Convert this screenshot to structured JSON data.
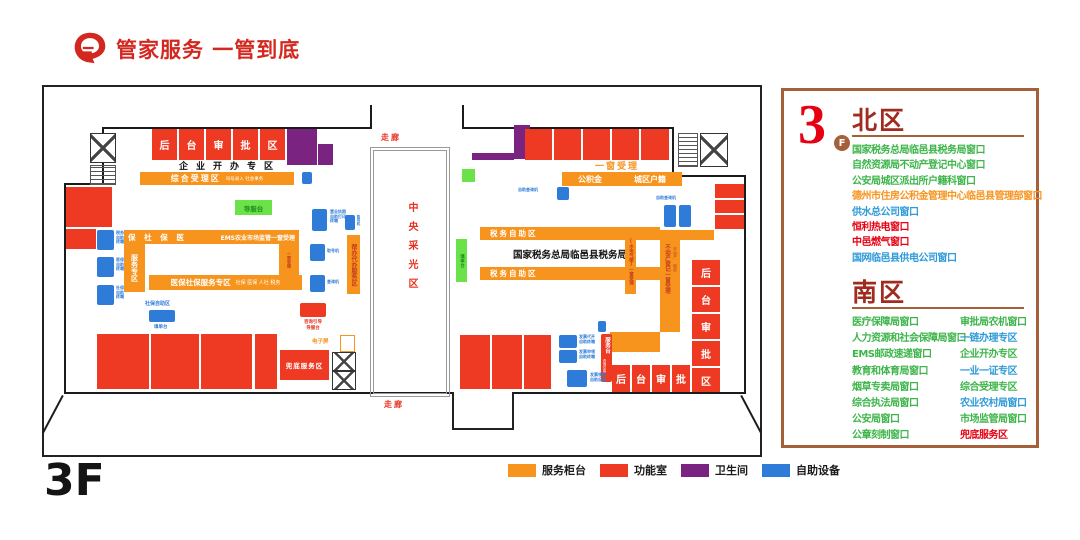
{
  "title": "管家服务 一管到底",
  "floor_big_label": "3F",
  "legend": [
    {
      "label": "服务柜台",
      "color": "#F7941E"
    },
    {
      "label": "功能室",
      "color": "#EE3A22"
    },
    {
      "label": "卫生间",
      "color": "#7B2381"
    },
    {
      "label": "自助设备",
      "color": "#2F7CD8"
    }
  ],
  "panel": {
    "floor_number": "3",
    "floor_badge": "F",
    "north": {
      "heading": "北区",
      "items": [
        {
          "text": "国家税务总局临邑县税务局窗口",
          "color": "#3DB54A"
        },
        {
          "text": "自然资源局不动产登记中心窗口",
          "color": "#3DB54A"
        },
        {
          "text": "公安局城区派出所户籍科窗口",
          "color": "#3DB54A"
        },
        {
          "text": "德州市住房公积金管理中心临邑县管理部窗口",
          "color": "#F7941E"
        },
        {
          "text": "供水总公司窗口",
          "color": "#2E9BD8"
        },
        {
          "text": "恒利热电窗口",
          "color": "#E60012"
        },
        {
          "text": "中邑燃气窗口",
          "color": "#E60012"
        },
        {
          "text": "国网临邑县供电公司窗口",
          "color": "#2E9BD8"
        }
      ]
    },
    "south": {
      "heading": "南区",
      "col1": [
        {
          "text": "医疗保障局窗口",
          "color": "#3DB54A"
        },
        {
          "text": "人力资源和社会保障局窗口",
          "color": "#3DB54A"
        },
        {
          "text": "EMS邮政速递窗口",
          "color": "#3DB54A"
        },
        {
          "text": "教育和体育局窗口",
          "color": "#3DB54A"
        },
        {
          "text": "烟草专卖局窗口",
          "color": "#3DB54A"
        },
        {
          "text": "综合执法局窗口",
          "color": "#3DB54A"
        },
        {
          "text": "公安局窗口",
          "color": "#3DB54A"
        },
        {
          "text": "公章刻制窗口",
          "color": "#3DB54A"
        }
      ],
      "col2": [
        {
          "text": "审批局农机窗口",
          "color": "#3DB54A"
        },
        {
          "text": "一链办理专区",
          "color": "#2E9BD8"
        },
        {
          "text": "企业开办专区",
          "color": "#3DB54A"
        },
        {
          "text": "一业一证专区",
          "color": "#2E9BD8"
        },
        {
          "text": "综合受理专区",
          "color": "#3DB54A"
        },
        {
          "text": "农业农村局窗口",
          "color": "#2E9BD8"
        },
        {
          "text": "市场监管局窗口",
          "color": "#3DB54A"
        },
        {
          "text": "兜底服务区",
          "color": "#E60012"
        }
      ]
    }
  },
  "plan": {
    "corridor_top": "走廊",
    "corridor_bottom": "走廊",
    "atrium": "中央采光区",
    "enterprise_zone": "企业开办专区",
    "acceptance_main": "综合受理区",
    "acceptance_sub": "叫号录入  社会事务",
    "guide_desk": "导服台",
    "consult_line1": "咨询引导",
    "consult_line2": "导服台",
    "med_top_left": "保 社 保 医",
    "med_top_right": "EMS农业市场监管一窗受理",
    "med_left_vert": "服务专区",
    "med_bottom_main": "医保社保服务专区",
    "med_bottom_sub": "社保 医保 人社 税务",
    "med_right_vert": "一窗受理",
    "bangban": "帮办代办服务区",
    "sb_zone_title": "社保自助区",
    "sb_zone_desk": "填单台",
    "form_desk": "填单台",
    "one_window": "一窗受理",
    "gjj": "公积金",
    "hukou": "城区户籍",
    "tax_self_top": "税务自助区",
    "tax_self_bottom": "税务自助区",
    "tax_bureau": "国家税务总局临邑县税务局",
    "utility_vert": "[水电气暖]一窗受理",
    "realestate_main": "不动产登记一窗受理",
    "realestate_sub": "不动产 税务",
    "service_bar_main": "服务台",
    "service_bar_sub": "咨询引导",
    "doudi": "兜底服务区",
    "screen": "电子屏",
    "elevator": "电梯",
    "back_top": [
      "后",
      "台",
      "审",
      "批",
      "区"
    ],
    "back_right": [
      "后",
      "台",
      "审",
      "批",
      "区"
    ],
    "back_bottom": [
      "后",
      "台",
      "审",
      "批"
    ],
    "kiosks": {
      "tax": [
        "税务",
        "自助",
        "终端"
      ],
      "med": [
        "医保",
        "自助",
        "终端"
      ],
      "soc": [
        "社保",
        "自助",
        "终端"
      ],
      "license": [
        "营业执照",
        "自助打印",
        "终端"
      ],
      "number": "取号机",
      "query": "查询机",
      "number2": "取号机",
      "query_kiosk": "自助查询机",
      "query_kiosk2": "自助查询机",
      "inv1": [
        "发票代开",
        "自助终端"
      ],
      "inv2": [
        "发票申领",
        "自助终端"
      ],
      "inv3": [
        "发票领取",
        "自助设备"
      ]
    }
  }
}
